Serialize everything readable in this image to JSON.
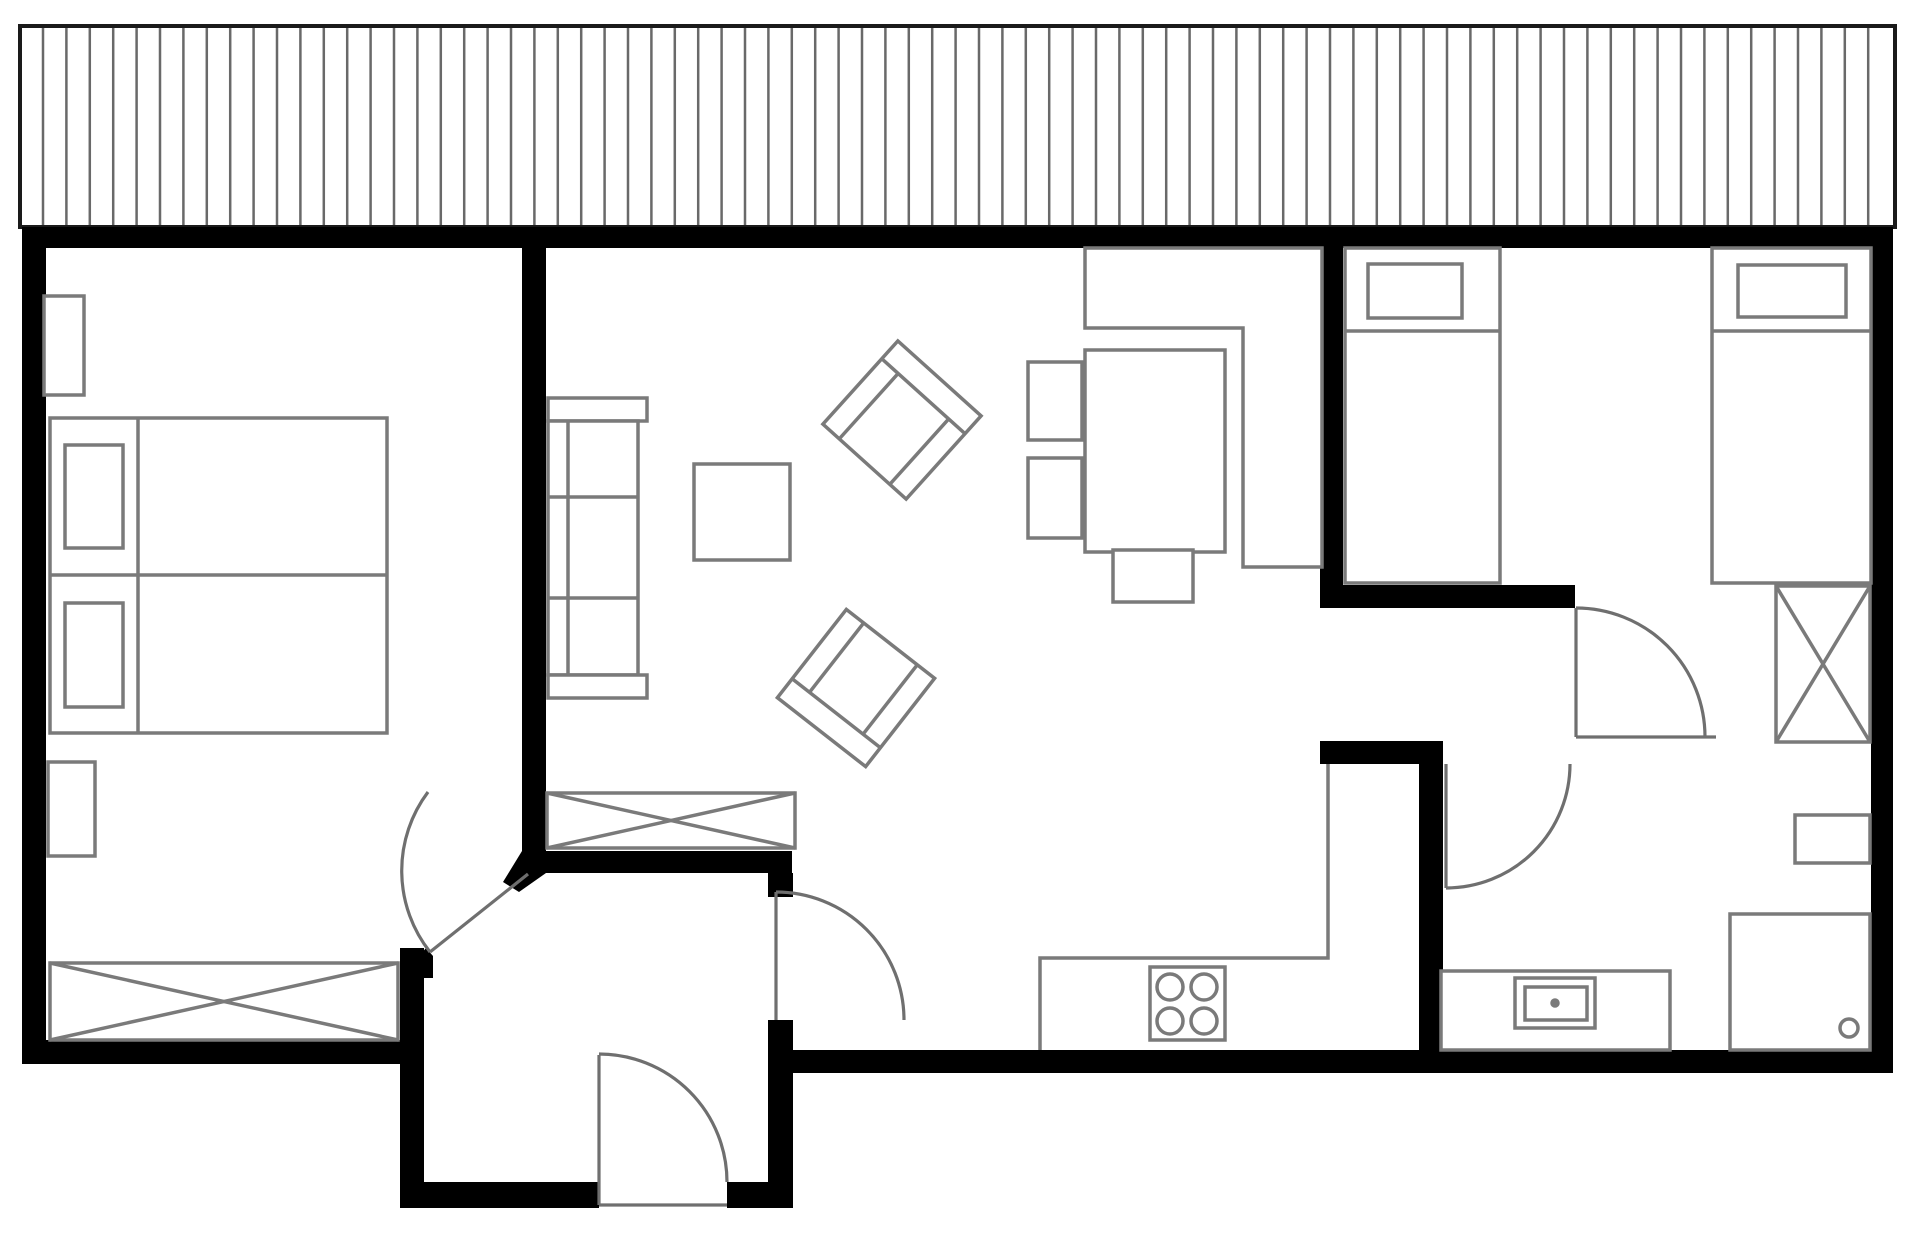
{
  "canvas": {
    "width": 1920,
    "height": 1234,
    "background": "#ffffff"
  },
  "palette": {
    "wall": "#000000",
    "line": "#7a7a7a",
    "door": "#6f6f6f",
    "deck_line": "#696969",
    "deck_border": "#1a1a1a",
    "white": "#ffffff",
    "none": "none"
  },
  "deck": {
    "name": "deck-terrace",
    "x": 20,
    "y": 26,
    "width": 1875,
    "height": 201,
    "hatch_start": 43,
    "hatch_spacing": 23.4,
    "hatch_count": 79,
    "hatch_y1": 28,
    "hatch_y2": 225
  },
  "elements": [
    {
      "name": "wall-exterior-top",
      "tag": "rect",
      "x": 22,
      "y": 227,
      "w": 1871,
      "h": 21,
      "fill": "wall"
    },
    {
      "name": "wall-exterior-left",
      "tag": "rect",
      "x": 22,
      "y": 227,
      "w": 24,
      "h": 837,
      "fill": "wall"
    },
    {
      "name": "wall-exterior-right",
      "tag": "rect",
      "x": 1871,
      "y": 227,
      "w": 22,
      "h": 846,
      "fill": "wall"
    },
    {
      "name": "wall-bottom-left",
      "tag": "rect",
      "x": 22,
      "y": 1040,
      "w": 402,
      "h": 24,
      "fill": "wall"
    },
    {
      "name": "wall-bottom-right",
      "tag": "rect",
      "x": 768,
      "y": 1050,
      "w": 1125,
      "h": 23,
      "fill": "wall"
    },
    {
      "name": "wall-bedroom1-living",
      "tag": "rect",
      "x": 522,
      "y": 227,
      "w": 24,
      "h": 646,
      "fill": "wall"
    },
    {
      "name": "wall-hall-top",
      "tag": "rect",
      "x": 522,
      "y": 851,
      "w": 270,
      "h": 22,
      "fill": "wall"
    },
    {
      "name": "wall-hall-corner-bevel",
      "tag": "polygon",
      "points": "522,851 546,851 546,873 519,892 503,882",
      "fill": "wall"
    },
    {
      "name": "wall-hall-east-upper",
      "tag": "rect",
      "x": 768,
      "y": 873,
      "w": 25,
      "h": 24,
      "fill": "wall"
    },
    {
      "name": "wall-hall-east-lower",
      "tag": "rect",
      "x": 768,
      "y": 1020,
      "w": 25,
      "h": 188,
      "fill": "wall"
    },
    {
      "name": "wall-vestibule-left",
      "tag": "rect",
      "x": 400,
      "y": 948,
      "w": 24,
      "h": 260,
      "fill": "wall"
    },
    {
      "name": "wall-vestibule-bevel",
      "tag": "polygon",
      "points": "400,978 426,948 433,956 433,978",
      "fill": "wall"
    },
    {
      "name": "wall-vestibule-bottom-left",
      "tag": "rect",
      "x": 400,
      "y": 1182,
      "w": 199,
      "h": 26,
      "fill": "wall"
    },
    {
      "name": "wall-vestibule-bottom-right",
      "tag": "rect",
      "x": 727,
      "y": 1182,
      "w": 66,
      "h": 26,
      "fill": "wall"
    },
    {
      "name": "wall-living-right-divider",
      "tag": "rect",
      "x": 1320,
      "y": 227,
      "w": 23,
      "h": 381,
      "fill": "wall"
    },
    {
      "name": "wall-bedroom2-south",
      "tag": "rect",
      "x": 1342,
      "y": 585,
      "w": 233,
      "h": 23,
      "fill": "wall"
    },
    {
      "name": "wall-corridor-bottom",
      "tag": "rect",
      "x": 1320,
      "y": 741,
      "w": 123,
      "h": 23,
      "fill": "wall"
    },
    {
      "name": "wall-bathroom-west",
      "tag": "rect",
      "x": 1419,
      "y": 741,
      "w": 24,
      "h": 332,
      "fill": "wall"
    },
    {
      "name": "nightstand-top",
      "tag": "rect",
      "x": 44,
      "y": 296,
      "w": 40,
      "h": 99,
      "stroke": "line",
      "fill": "white"
    },
    {
      "name": "nightstand-bottom",
      "tag": "rect",
      "x": 48,
      "y": 762,
      "w": 47,
      "h": 94,
      "stroke": "line",
      "fill": "white"
    },
    {
      "name": "double-bed",
      "tag": "rect",
      "x": 50,
      "y": 418,
      "w": 337,
      "h": 315,
      "stroke": "line",
      "fill": "white"
    },
    {
      "name": "double-bed-divider",
      "tag": "line",
      "x1": 50,
      "y1": 575,
      "x2": 387,
      "y2": 575,
      "stroke": "line"
    },
    {
      "name": "double-bed-headline",
      "tag": "line",
      "x1": 138,
      "y1": 418,
      "x2": 138,
      "y2": 733,
      "stroke": "line"
    },
    {
      "name": "pillow-1",
      "tag": "rect",
      "x": 65,
      "y": 445,
      "w": 58,
      "h": 103,
      "stroke": "line",
      "fill": "white"
    },
    {
      "name": "pillow-2",
      "tag": "rect",
      "x": 65,
      "y": 603,
      "w": 58,
      "h": 104,
      "stroke": "line",
      "fill": "white"
    },
    {
      "name": "wardrobe-bedroom1",
      "tag": "rect",
      "x": 50,
      "y": 963,
      "w": 348,
      "h": 77,
      "stroke": "line",
      "fill": "white"
    },
    {
      "name": "wardrobe-bedroom1-x1",
      "tag": "line",
      "x1": 50,
      "y1": 963,
      "x2": 398,
      "y2": 1040,
      "stroke": "line"
    },
    {
      "name": "wardrobe-bedroom1-x2",
      "tag": "line",
      "x1": 50,
      "y1": 1040,
      "x2": 398,
      "y2": 963,
      "stroke": "line"
    },
    {
      "name": "closet-hall",
      "tag": "rect",
      "x": 547,
      "y": 793,
      "w": 248,
      "h": 55,
      "stroke": "line",
      "fill": "white"
    },
    {
      "name": "closet-hall-x1",
      "tag": "line",
      "x1": 547,
      "y1": 793,
      "x2": 795,
      "y2": 848,
      "stroke": "line"
    },
    {
      "name": "closet-hall-x2",
      "tag": "line",
      "x1": 547,
      "y1": 848,
      "x2": 795,
      "y2": 793,
      "stroke": "line"
    },
    {
      "name": "sofa-armrest-top",
      "tag": "rect",
      "x": 548,
      "y": 398,
      "w": 99,
      "h": 23,
      "stroke": "line",
      "fill": "white"
    },
    {
      "name": "sofa-body",
      "tag": "rect",
      "x": 548,
      "y": 421,
      "w": 90,
      "h": 254,
      "stroke": "line",
      "fill": "white"
    },
    {
      "name": "sofa-back-line",
      "tag": "line",
      "x1": 568,
      "y1": 421,
      "x2": 568,
      "y2": 675,
      "stroke": "line"
    },
    {
      "name": "sofa-cushion-line-1",
      "tag": "line",
      "x1": 548,
      "y1": 497,
      "x2": 638,
      "y2": 497,
      "stroke": "line"
    },
    {
      "name": "sofa-cushion-line-2",
      "tag": "line",
      "x1": 548,
      "y1": 598,
      "x2": 638,
      "y2": 598,
      "stroke": "line"
    },
    {
      "name": "sofa-armrest-bottom",
      "tag": "rect",
      "x": 548,
      "y": 675,
      "w": 99,
      "h": 23,
      "stroke": "line",
      "fill": "white"
    },
    {
      "name": "coffee-table",
      "tag": "rect",
      "x": 694,
      "y": 464,
      "w": 96,
      "h": 96,
      "stroke": "line",
      "fill": "white"
    },
    {
      "name": "armchair-1",
      "tag": "group",
      "tx": 902,
      "ty": 420,
      "rot": 42,
      "children": [
        {
          "name": "armchair-1-frame",
          "tag": "rect",
          "x": -56,
          "y": -56,
          "w": 112,
          "h": 112,
          "stroke": "line",
          "fill": "white"
        },
        {
          "name": "armchair-1-back",
          "tag": "line",
          "x1": -56,
          "y1": -32,
          "x2": 56,
          "y2": -32,
          "stroke": "line"
        },
        {
          "name": "armchair-1-arm-l",
          "tag": "line",
          "x1": -34,
          "y1": -32,
          "x2": -34,
          "y2": 56,
          "stroke": "line"
        },
        {
          "name": "armchair-1-arm-r",
          "tag": "line",
          "x1": 34,
          "y1": -32,
          "x2": 34,
          "y2": 56,
          "stroke": "line"
        }
      ]
    },
    {
      "name": "armchair-2",
      "tag": "group",
      "tx": 856,
      "ty": 688,
      "rot": 218,
      "children": [
        {
          "name": "armchair-2-frame",
          "tag": "rect",
          "x": -56,
          "y": -56,
          "w": 112,
          "h": 112,
          "stroke": "line",
          "fill": "white"
        },
        {
          "name": "armchair-2-back",
          "tag": "line",
          "x1": -56,
          "y1": -32,
          "x2": 56,
          "y2": -32,
          "stroke": "line"
        },
        {
          "name": "armchair-2-arm-l",
          "tag": "line",
          "x1": -34,
          "y1": -32,
          "x2": -34,
          "y2": 56,
          "stroke": "line"
        },
        {
          "name": "armchair-2-arm-r",
          "tag": "line",
          "x1": 34,
          "y1": -32,
          "x2": 34,
          "y2": 56,
          "stroke": "line"
        }
      ]
    },
    {
      "name": "dining-table",
      "tag": "rect",
      "x": 1085,
      "y": 350,
      "w": 140,
      "h": 202,
      "stroke": "line",
      "fill": "white"
    },
    {
      "name": "dining-chair-1",
      "tag": "rect",
      "x": 1028,
      "y": 362,
      "w": 54,
      "h": 78,
      "stroke": "line",
      "fill": "white"
    },
    {
      "name": "dining-chair-2",
      "tag": "rect",
      "x": 1028,
      "y": 458,
      "w": 54,
      "h": 80,
      "stroke": "line",
      "fill": "white"
    },
    {
      "name": "dining-chair-3",
      "tag": "rect",
      "x": 1113,
      "y": 550,
      "w": 80,
      "h": 52,
      "stroke": "line",
      "fill": "white"
    },
    {
      "name": "kitchen-counter-top",
      "tag": "path",
      "d": "M 1085 248 L 1085 328 L 1243 328 L 1243 567 L 1322 567 L 1322 248 Z",
      "stroke": "line",
      "fill": "white"
    },
    {
      "name": "kitchen-counter-bottom",
      "tag": "path",
      "d": "M 1040 1050 L 1040 958 L 1328 958 L 1328 764",
      "stroke": "line",
      "fill": "none"
    },
    {
      "name": "stove",
      "tag": "rect",
      "x": 1150,
      "y": 967,
      "w": 75,
      "h": 73,
      "stroke": "line",
      "fill": "white"
    },
    {
      "name": "burner-1",
      "tag": "circle",
      "cx": 1170,
      "cy": 987,
      "r": 13,
      "stroke": "line",
      "fill": "white"
    },
    {
      "name": "burner-2",
      "tag": "circle",
      "cx": 1204,
      "cy": 987,
      "r": 13,
      "stroke": "line",
      "fill": "white"
    },
    {
      "name": "burner-3",
      "tag": "circle",
      "cx": 1170,
      "cy": 1021,
      "r": 13,
      "stroke": "line",
      "fill": "white"
    },
    {
      "name": "burner-4",
      "tag": "circle",
      "cx": 1204,
      "cy": 1021,
      "r": 13,
      "stroke": "line",
      "fill": "white"
    },
    {
      "name": "single-bed-left",
      "tag": "rect",
      "x": 1345,
      "y": 248,
      "w": 155,
      "h": 335,
      "stroke": "line",
      "fill": "white"
    },
    {
      "name": "single-bed-left-pillow",
      "tag": "rect",
      "x": 1368,
      "y": 264,
      "w": 94,
      "h": 54,
      "stroke": "line",
      "fill": "white"
    },
    {
      "name": "single-bed-left-line",
      "tag": "line",
      "x1": 1345,
      "y1": 331,
      "x2": 1500,
      "y2": 331,
      "stroke": "line"
    },
    {
      "name": "single-bed-right",
      "tag": "rect",
      "x": 1712,
      "y": 248,
      "w": 159,
      "h": 335,
      "stroke": "line",
      "fill": "white"
    },
    {
      "name": "single-bed-right-pillow",
      "tag": "rect",
      "x": 1738,
      "y": 265,
      "w": 108,
      "h": 52,
      "stroke": "line",
      "fill": "white"
    },
    {
      "name": "single-bed-right-line",
      "tag": "line",
      "x1": 1712,
      "y1": 331,
      "x2": 1871,
      "y2": 331,
      "stroke": "line"
    },
    {
      "name": "wardrobe-corridor",
      "tag": "rect",
      "x": 1776,
      "y": 586,
      "w": 94,
      "h": 156,
      "stroke": "line",
      "fill": "white"
    },
    {
      "name": "wardrobe-corridor-x1",
      "tag": "line",
      "x1": 1776,
      "y1": 586,
      "x2": 1870,
      "y2": 742,
      "stroke": "line"
    },
    {
      "name": "wardrobe-corridor-x2",
      "tag": "line",
      "x1": 1776,
      "y1": 742,
      "x2": 1870,
      "y2": 586,
      "stroke": "line"
    },
    {
      "name": "bathroom-vanity",
      "tag": "rect",
      "x": 1441,
      "y": 971,
      "w": 229,
      "h": 79,
      "stroke": "line",
      "fill": "white"
    },
    {
      "name": "bathroom-sink-outer",
      "tag": "rect",
      "x": 1515,
      "y": 978,
      "w": 80,
      "h": 50,
      "stroke": "line",
      "fill": "white"
    },
    {
      "name": "bathroom-sink-inner",
      "tag": "rect",
      "x": 1525,
      "y": 987,
      "w": 62,
      "h": 33,
      "stroke": "line",
      "fill": "white"
    },
    {
      "name": "bathroom-sink-drain",
      "tag": "circle",
      "cx": 1555,
      "cy": 1003,
      "r": 3,
      "stroke": "line",
      "fill": "line"
    },
    {
      "name": "bathroom-cabinet",
      "tag": "rect",
      "x": 1795,
      "y": 815,
      "w": 75,
      "h": 48,
      "stroke": "line",
      "fill": "white"
    },
    {
      "name": "shower",
      "tag": "rect",
      "x": 1730,
      "y": 914,
      "w": 140,
      "h": 136,
      "stroke": "line",
      "fill": "white"
    },
    {
      "name": "shower-drain",
      "tag": "circle",
      "cx": 1849,
      "cy": 1028,
      "r": 9,
      "stroke": "line",
      "fill": "white"
    },
    {
      "name": "door-bedroom1-leaf",
      "tag": "line",
      "x1": 430,
      "y1": 952,
      "x2": 528,
      "y2": 874,
      "stroke": "door"
    },
    {
      "name": "door-bedroom1-arc",
      "tag": "path",
      "d": "M 428 792 A 131 131 0 0 0 430 952",
      "stroke": "door",
      "fill": "none"
    },
    {
      "name": "door-hall-living-leaf",
      "tag": "line",
      "x1": 776,
      "y1": 892,
      "x2": 776,
      "y2": 1020,
      "stroke": "door"
    },
    {
      "name": "door-hall-living-arc",
      "tag": "path",
      "d": "M 776 892 A 128 128 0 0 1 904 1020",
      "stroke": "door",
      "fill": "none"
    },
    {
      "name": "door-entry-leaf",
      "tag": "line",
      "x1": 599,
      "y1": 1055,
      "x2": 599,
      "y2": 1205,
      "stroke": "door"
    },
    {
      "name": "door-entry-sill",
      "tag": "line",
      "x1": 599,
      "y1": 1205,
      "x2": 727,
      "y2": 1205,
      "stroke": "door"
    },
    {
      "name": "door-entry-arc",
      "tag": "path",
      "d": "M 599 1054 A 128 128 0 0 1 727 1182",
      "stroke": "door",
      "fill": "none"
    },
    {
      "name": "door-bedroom2-leaf",
      "tag": "line",
      "x1": 1576,
      "y1": 608,
      "x2": 1576,
      "y2": 737,
      "stroke": "door"
    },
    {
      "name": "door-bedroom2-closed",
      "tag": "line",
      "x1": 1576,
      "y1": 737,
      "x2": 1716,
      "y2": 737,
      "stroke": "door"
    },
    {
      "name": "door-bedroom2-arc",
      "tag": "path",
      "d": "M 1576 608 A 129 129 0 0 1 1705 737",
      "stroke": "door",
      "fill": "none"
    },
    {
      "name": "door-bathroom-leaf",
      "tag": "line",
      "x1": 1446,
      "y1": 764,
      "x2": 1446,
      "y2": 888,
      "stroke": "door"
    },
    {
      "name": "door-bathroom-arc",
      "tag": "path",
      "d": "M 1570 764 A 124 124 0 0 1 1446 888",
      "stroke": "door",
      "fill": "none"
    }
  ],
  "stroke_width": {
    "furniture": 3.5,
    "door": 3.2,
    "deck_hatch": 2.5,
    "deck_border": 4
  }
}
